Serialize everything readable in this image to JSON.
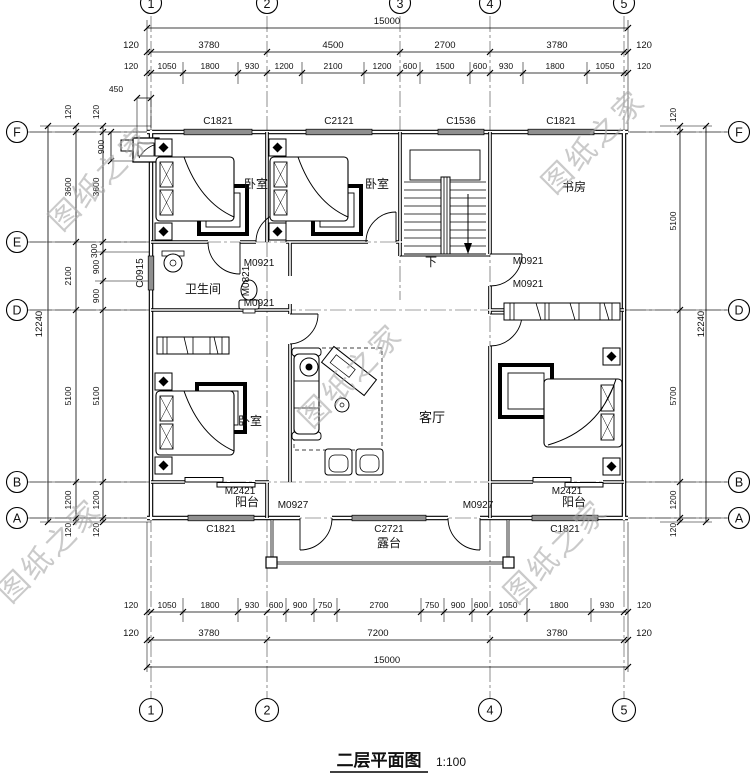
{
  "drawing": {
    "title": "二层平面图",
    "scale": "1:100",
    "watermark": "图纸之家"
  },
  "grid": {
    "cols": [
      "1",
      "2",
      "3",
      "4",
      "5"
    ],
    "left_rows": [
      "F",
      "E",
      "D",
      "B",
      "A"
    ],
    "right_rows": [
      "F",
      "D",
      "B",
      "A"
    ]
  },
  "rooms": {
    "bedroom": "卧室",
    "bathroom": "卫生间",
    "living_room": "客厅",
    "study": "书房",
    "balcony": "阳台",
    "terrace": "露台",
    "stairs_down": "下"
  },
  "openings": {
    "c1821": "C1821",
    "c2121": "C2121",
    "c1536": "C1536",
    "c0915": "C0915",
    "c2721": "C2721",
    "m0921": "M0921",
    "m0821": "M0821",
    "m0927": "M0927",
    "m2421": "M2421"
  },
  "dims": {
    "overall_width": "15000",
    "overall_height": "12240",
    "top_row2": [
      "120",
      "3780",
      "4500",
      "2700",
      "3780",
      "120"
    ],
    "top_row3": [
      "120",
      "1050",
      "1800",
      "930",
      "1200",
      "2100",
      "1200",
      "600",
      "1500",
      "600",
      "930",
      "1800",
      "1050",
      "120"
    ],
    "bottom_row1": [
      "120",
      "1050",
      "1800",
      "930",
      "600",
      "900",
      "750",
      "2700",
      "750",
      "900",
      "600",
      "1050",
      "1800",
      "930",
      "120"
    ],
    "bottom_row2": [
      "120",
      "3780",
      "7200",
      "3780",
      "120"
    ],
    "left_outer": [
      "120",
      "3600",
      "2100",
      "5100",
      "1200",
      "120"
    ],
    "left_inner": [
      "120",
      "3600",
      "300",
      "900",
      "900",
      "5100",
      "1200",
      "120"
    ],
    "right_chain": [
      "120",
      "5100",
      "5700",
      "1200",
      "120"
    ],
    "offset_450": "450",
    "offset_900": "900"
  }
}
